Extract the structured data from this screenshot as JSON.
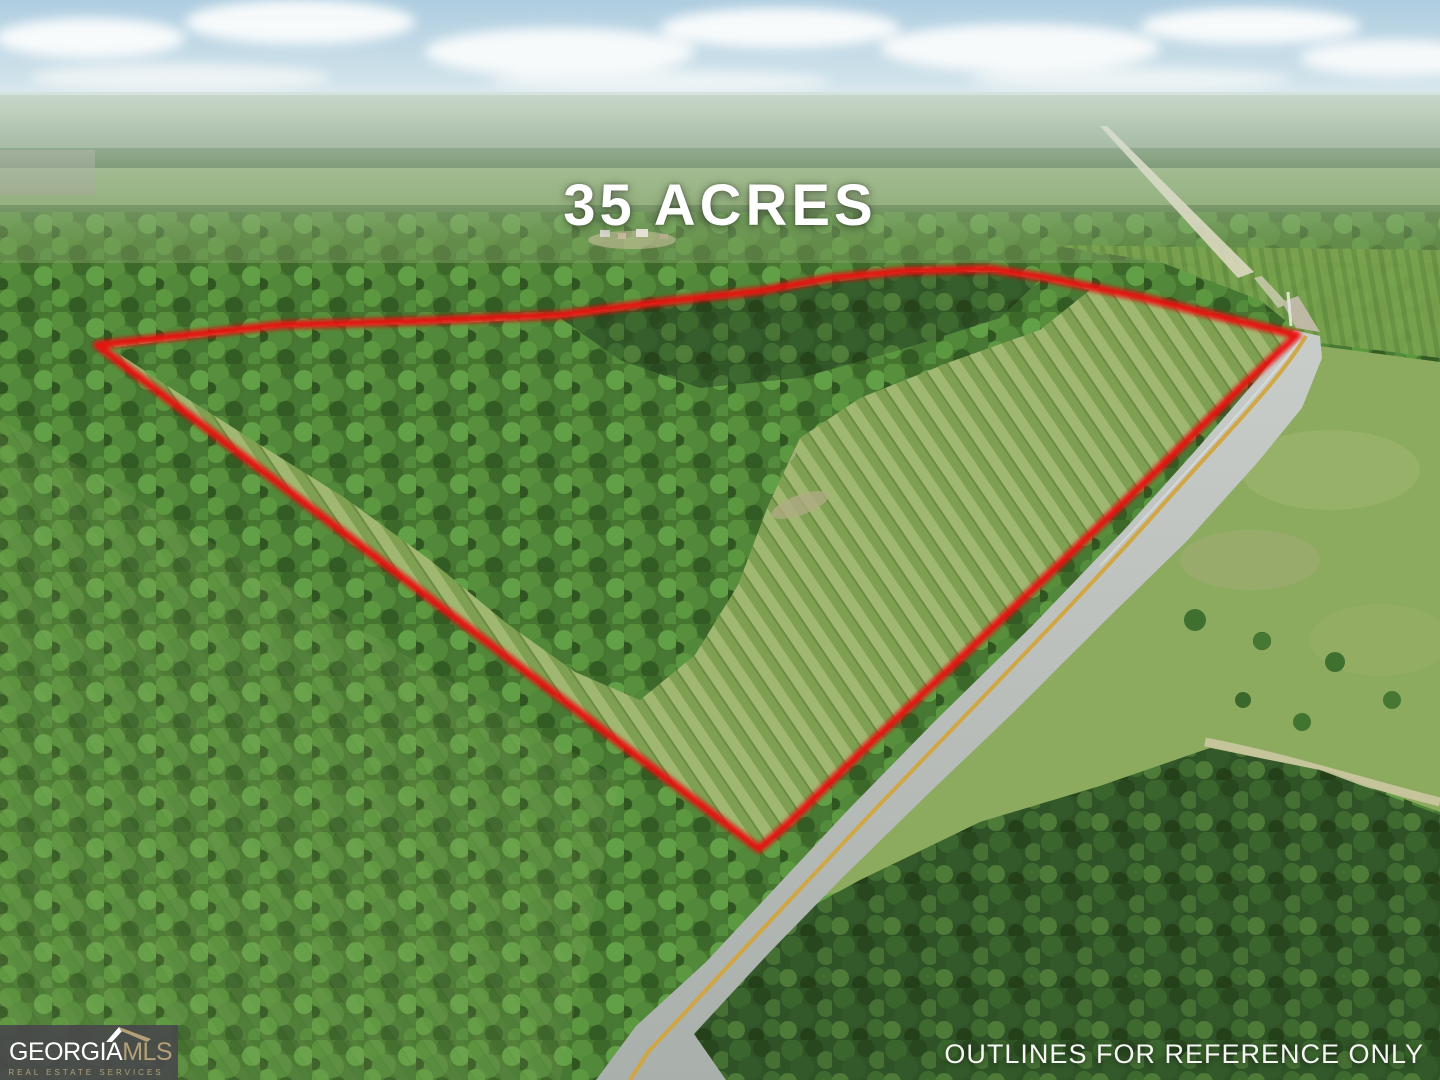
{
  "overlay": {
    "acreage": "35 ACRES",
    "disclaimer": "OUTLINES FOR REFERENCE ONLY"
  },
  "brand": {
    "name_primary": "GEORGIA",
    "name_secondary": "MLS",
    "tagline": "REAL ESTATE SERVICES"
  },
  "colors": {
    "outline_red": "#EC0B0B",
    "logo_gold": "#B3A077",
    "logo_background": "#49494B",
    "overlay_text": "#FFFFFF"
  }
}
